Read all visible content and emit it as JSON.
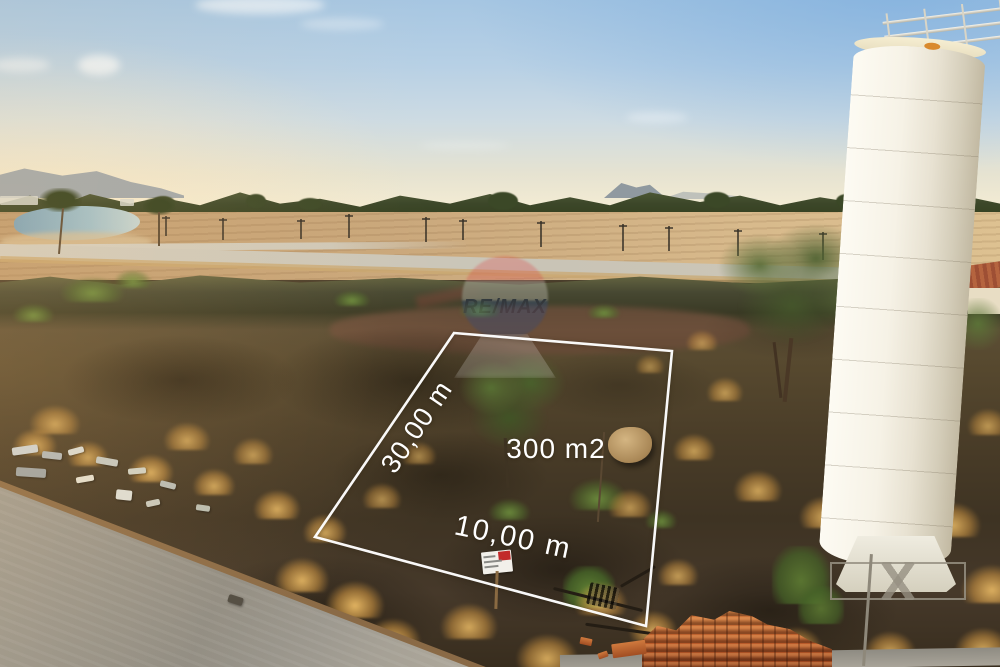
{
  "annotations": {
    "side_length": "30,00 m",
    "area": "300 m2",
    "front_length": "10,00 m"
  },
  "watermark": {
    "brand": "RE/MAX",
    "balloon_colors": {
      "top": "#d83f46",
      "middle": "#efeadf",
      "bottom": "#27477f"
    },
    "text_color": "#15265c"
  },
  "colors": {
    "lot_outline": "#ffffff",
    "label_text": "#ffffff",
    "sign_red": "#c22a2a",
    "sky_top": "#a6c6e2",
    "sky_horizon": "#f4ecd4"
  }
}
